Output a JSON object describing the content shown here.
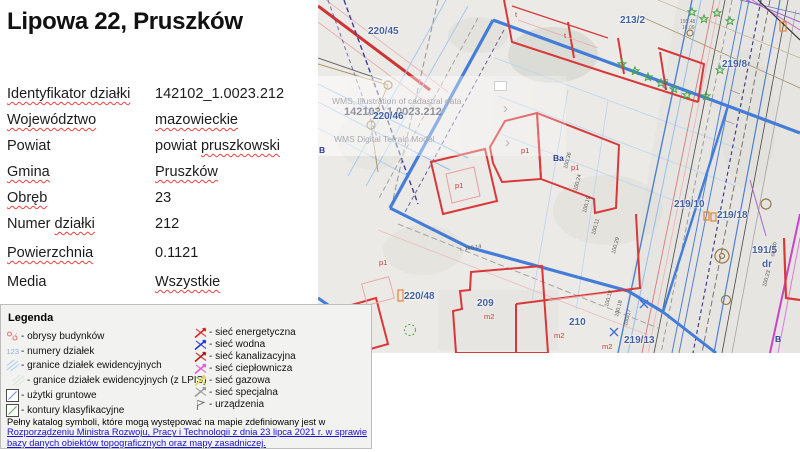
{
  "page": {
    "title": "Lipowa 22, Pruszków"
  },
  "details": {
    "rows": [
      {
        "label": [
          {
            "t": "Identyfikator działki",
            "sp": true
          }
        ],
        "value": [
          {
            "t": "142102_1.0023.212",
            "sp": false
          }
        ]
      },
      {
        "label": [
          {
            "t": "Województwo",
            "sp": true
          }
        ],
        "value": [
          {
            "t": "mazowieckie",
            "sp": true
          }
        ]
      },
      {
        "label": [
          {
            "t": "Powiat",
            "sp": false
          }
        ],
        "value": [
          {
            "t": "powiat ",
            "sp": false
          },
          {
            "t": "pruszkowski",
            "sp": true
          }
        ]
      },
      {
        "label": [
          {
            "t": "Gmina",
            "sp": true
          }
        ],
        "value": [
          {
            "t": "Pruszków",
            "sp": true
          }
        ]
      },
      {
        "label": [
          {
            "t": "Obręb",
            "sp": true
          }
        ],
        "value": [
          {
            "t": "23",
            "sp": false
          }
        ]
      },
      {
        "label": [
          {
            "t": "Numer ",
            "sp": false
          },
          {
            "t": "działki",
            "sp": true
          }
        ],
        "value": [
          {
            "t": "212",
            "sp": false
          }
        ]
      },
      {
        "label": [
          {
            "t": "Powierzchnia",
            "sp": true
          }
        ],
        "gap": true,
        "value": [
          {
            "t": "0.1121",
            "sp": false
          }
        ]
      },
      {
        "label": [
          {
            "t": "Media",
            "sp": false
          }
        ],
        "gap": true,
        "value": [
          {
            "t": "Wszystkie",
            "sp": true
          }
        ]
      }
    ]
  },
  "legend": {
    "title": "Legenda",
    "left_items": [
      {
        "icon": "buildings",
        "label": "- obrysy budynków"
      },
      {
        "icon": "digits",
        "label": "- numery działek"
      },
      {
        "icon": "lines",
        "color": "#a9cdf2",
        "name": "parcel-borders-icon",
        "label": "- granice działek ewidencyjnych"
      },
      {
        "icon": "lines",
        "color": "#bce2bc",
        "name": "parcel-borders-lpis-icon",
        "label": "- granice działek ewidencyjnych (z LPIS)",
        "indent": true
      },
      {
        "icon": "square",
        "color": "#6a93d8",
        "name": "land-use-icon",
        "label": "- użytki gruntowe"
      },
      {
        "icon": "square",
        "color": "#58ad58",
        "name": "soil-contours-icon",
        "label": "- kontury klasyfikacyjne"
      }
    ],
    "right_items": [
      {
        "icon": "cross",
        "color": "#e02020",
        "name": "power-network-icon",
        "label": "- sieć energetyczna"
      },
      {
        "icon": "cross",
        "color": "#2238cc",
        "name": "water-network-icon",
        "label": "- sieć wodna"
      },
      {
        "icon": "cross",
        "color": "#b01818",
        "name": "sewage-network-icon",
        "label": "- sieć kanalizacyjna"
      },
      {
        "icon": "cross",
        "color": "#e058d8",
        "name": "heating-network-icon",
        "label": "- sieć ciepłownicza"
      },
      {
        "icon": "cross",
        "color": "#e0da4e",
        "name": "gas-network-icon",
        "label": "- sieć gazowa"
      },
      {
        "icon": "cross",
        "color": "#9a9a9a",
        "name": "special-network-icon",
        "label": "- sieć specjalna"
      },
      {
        "icon": "flag",
        "color": "#808080",
        "name": "devices-icon",
        "label": "- urządzenia"
      }
    ],
    "footer": {
      "prefix": "Pełny katalog symboli, które mogą występować na mapie zdefiniowany jest w ",
      "link": "Rozporządzeniu Ministra Rozwoju, Pracy i Technologii z dnia 23 lipca 2021 r. w sprawie bazy danych obiektów topograficznych oraz mapy zasadniczej."
    }
  },
  "map": {
    "overlay": {
      "line1": "WMS, Illustration of cadastral data",
      "id": "142102_1.0023.212",
      "line2": "WMS Digital Terrain Model",
      "chevron": "›"
    },
    "colors": {
      "parcel_boundary": "#2f6fd4",
      "building_outline": "#d42222",
      "parcel_label": "#44619f",
      "utility_magenta": "#c32fc3",
      "tree_green": "#2f9e2f"
    },
    "labels": [
      {
        "t": "220/45",
        "x": 50,
        "y": 26,
        "cls": "parcel"
      },
      {
        "t": "220/46",
        "x": 55,
        "y": 111,
        "cls": "parcel"
      },
      {
        "t": "213/2",
        "x": 302,
        "y": 15,
        "cls": "parcel"
      },
      {
        "t": "219/8",
        "x": 404,
        "y": 59,
        "cls": "parcel"
      },
      {
        "t": "219/10",
        "x": 356,
        "y": 199,
        "cls": "parcel"
      },
      {
        "t": "219/18",
        "x": 399,
        "y": 210,
        "cls": "parcel"
      },
      {
        "t": "191/5",
        "x": 434,
        "y": 245,
        "cls": "parcel"
      },
      {
        "t": "dr",
        "x": 444,
        "y": 259,
        "cls": "parcel"
      },
      {
        "t": "219/13",
        "x": 306,
        "y": 335,
        "cls": "parcel"
      },
      {
        "t": "220/48",
        "x": 86,
        "y": 291,
        "cls": "parcel"
      },
      {
        "t": "209",
        "x": 159,
        "y": 298,
        "cls": "parcel"
      },
      {
        "t": "210",
        "x": 251,
        "y": 317,
        "cls": "parcel"
      },
      {
        "t": "Ba",
        "x": 235,
        "y": 153,
        "cls": "navy"
      },
      {
        "t": "B",
        "x": 457,
        "y": 334,
        "cls": "navy"
      },
      {
        "t": "B",
        "x": 1,
        "y": 145,
        "cls": "navy"
      },
      {
        "t": "p1",
        "x": 137,
        "y": 181,
        "cls": "red"
      },
      {
        "t": "p1",
        "x": 203,
        "y": 146,
        "cls": "red"
      },
      {
        "t": "p1",
        "x": 253,
        "y": 163,
        "cls": "red"
      },
      {
        "t": "p1",
        "x": 61,
        "y": 258,
        "cls": "red"
      },
      {
        "t": "t",
        "x": 197,
        "y": 10,
        "cls": "red"
      },
      {
        "t": "t",
        "x": 246,
        "y": 31,
        "cls": "red"
      },
      {
        "t": "m2",
        "x": 166,
        "y": 312,
        "cls": "red"
      },
      {
        "t": "m2",
        "x": 236,
        "y": 331,
        "cls": "red"
      },
      {
        "t": "m2",
        "x": 284,
        "y": 342,
        "cls": "red"
      },
      {
        "t": "∟100.14",
        "x": 141,
        "y": 247,
        "cls": "measure",
        "rot": -8
      },
      {
        "t": "100.36",
        "x": 245,
        "y": 168,
        "cls": "measure",
        "rot": -75
      },
      {
        "t": "100.24",
        "x": 255,
        "y": 190,
        "cls": "measure",
        "rot": -75
      },
      {
        "t": "100.19",
        "x": 264,
        "y": 212,
        "cls": "measure",
        "rot": -75
      },
      {
        "t": "100.11",
        "x": 273,
        "y": 234,
        "cls": "measure",
        "rot": -75
      },
      {
        "t": "100.29",
        "x": 293,
        "y": 253,
        "cls": "measure",
        "rot": -75
      },
      {
        "t": "100.12",
        "x": 286,
        "y": 306,
        "cls": "measure",
        "rot": -75
      },
      {
        "t": "100.18",
        "x": 296,
        "y": 316,
        "cls": "measure",
        "rot": -75
      },
      {
        "t": "100.17",
        "x": 305,
        "y": 325,
        "cls": "measure",
        "rot": -75
      },
      {
        "t": "100.23",
        "x": 444,
        "y": 286,
        "cls": "measure",
        "rot": -75
      },
      {
        "t": "j. kb",
        "x": 344,
        "y": 88,
        "cls": "measure",
        "rot": -75
      },
      {
        "t": "ch. kb",
        "x": 452,
        "y": 256,
        "cls": "measure",
        "rot": -80
      },
      {
        "t": "195.48",
        "x": 362,
        "y": 19,
        "cls": "tiny"
      },
      {
        "t": "18.09",
        "x": 364,
        "y": 25,
        "cls": "tiny"
      }
    ]
  }
}
